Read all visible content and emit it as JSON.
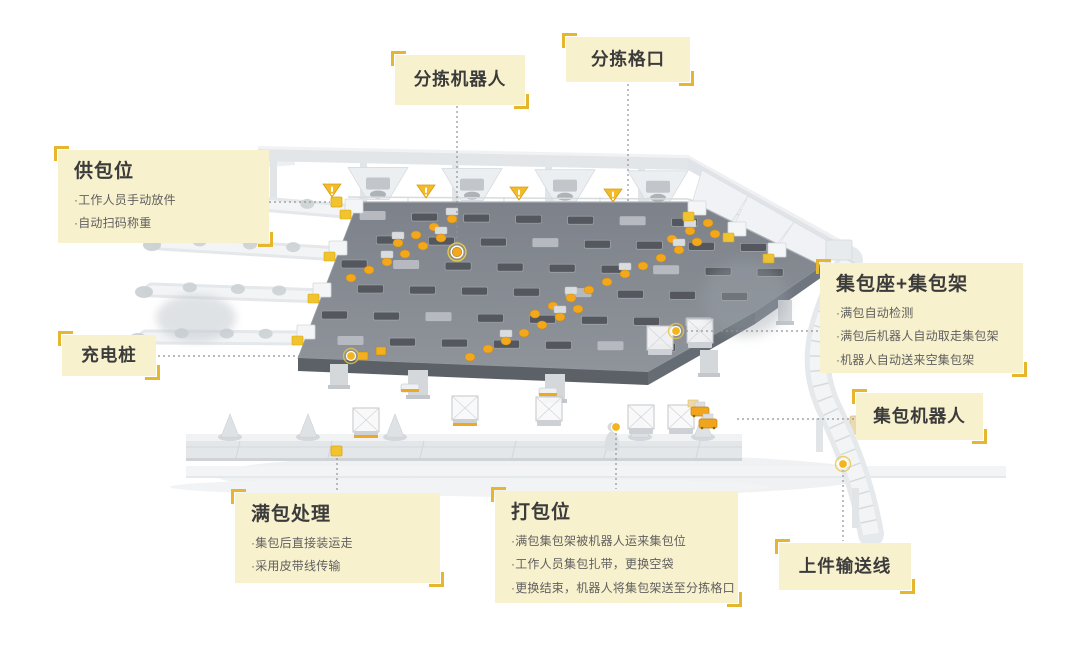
{
  "style": {
    "background": "#ffffff",
    "label_bg": "#f8f1cd",
    "bracket": "#e5b62e",
    "title_color": "#3b3b3b",
    "bullet_color": "#5f5f5f",
    "connector": "#8f9398",
    "accent_yellow": "#f3a81c",
    "anchor_yellow": "#f2b51c",
    "tag_yellow": "#f1c32f",
    "platform_dark": "#81868c",
    "structure_light": "#e4e7ea"
  },
  "callouts": [
    {
      "id": "sorting-robot",
      "title": "分拣机器人",
      "bullets": []
    },
    {
      "id": "sorting-chute",
      "title": "分拣格口",
      "bullets": []
    },
    {
      "id": "supply-station",
      "title": "供包位",
      "bullets": [
        "·工作人员手动放件",
        "·自动扫码称重"
      ]
    },
    {
      "id": "bag-seat-rack",
      "title": "集包座+集包架",
      "bullets": [
        "·满包自动检测",
        "·满包后机器人自动取走集包架",
        "·机器人自动送来空集包架"
      ]
    },
    {
      "id": "charging-pile",
      "title": "充电桩",
      "bullets": []
    },
    {
      "id": "full-bag-handling",
      "title": "满包处理",
      "bullets": [
        "·集包后直接装运走",
        "·采用皮带线传输"
      ]
    },
    {
      "id": "packing-station",
      "title": "打包位",
      "bullets": [
        "·满包集包架被机器人运来集包位",
        "·工作人员集包扎带，更换空袋",
        "·更换结束，机器人将集包架送至分拣格口"
      ]
    },
    {
      "id": "bagging-robot",
      "title": "集包机器人",
      "bullets": []
    },
    {
      "id": "loading-conveyor",
      "title": "上件输送线",
      "bullets": []
    }
  ]
}
